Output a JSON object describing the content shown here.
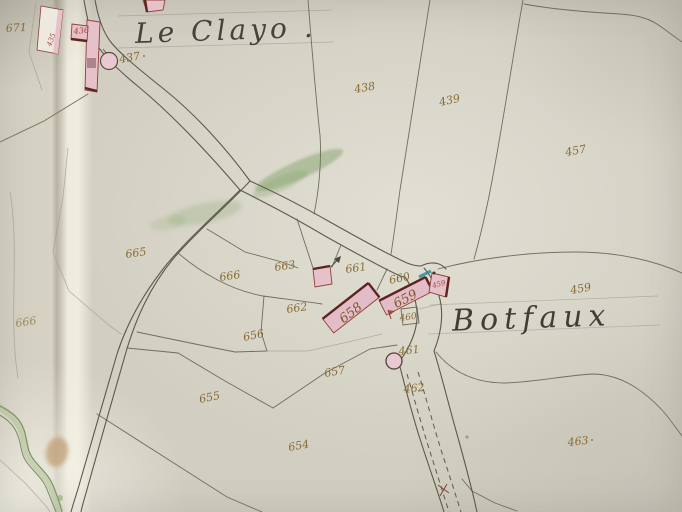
{
  "map": {
    "place_names": {
      "top": "Le Clayo .",
      "village": "Botfaux"
    },
    "parcel_numbers": [
      "671",
      "437",
      "438",
      "439",
      "457",
      "665",
      "666",
      "666",
      "663",
      "661",
      "660",
      "459",
      "662",
      "656",
      "460",
      "461",
      "462",
      "657",
      "655",
      "654",
      "463"
    ],
    "building_numbers": [
      "658",
      "659",
      "436",
      "459",
      "435"
    ],
    "colors": {
      "paper": "#d4d1c5",
      "fold_highlight": "#efecdf",
      "ink_titles": "#45433b",
      "ink_parcel_numbers": "#8a6a35",
      "ink_building_numbers_red": "#a8433c",
      "building_fill_pink": "#e5c1ca",
      "building_outline_carmine": "#8f3f39",
      "road_ink": "#5c5a49",
      "green_wash": "#8da874",
      "teal_mark": "#2f8e96"
    }
  }
}
